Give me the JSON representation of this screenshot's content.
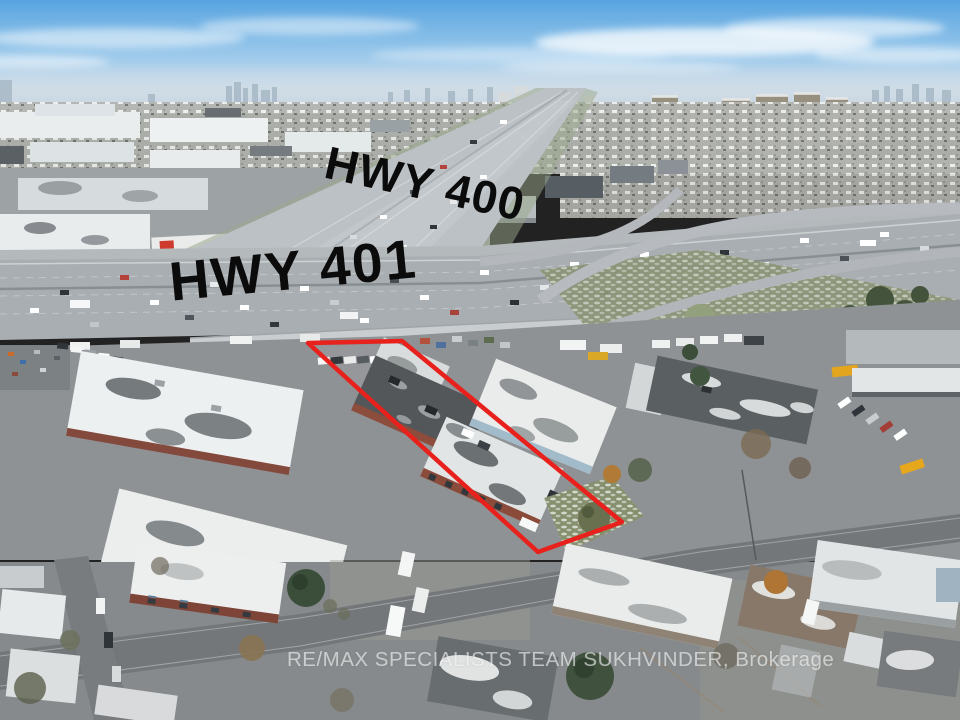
{
  "meta": {
    "type": "aerial-photograph",
    "subject": "Aerial drone view of industrial property near the Hwy 400 / Hwy 401 interchange with light snow dusting",
    "width_px": 960,
    "height_px": 720
  },
  "overlays": {
    "highway_labels": [
      {
        "id": "hwy-400",
        "text": "HWY 400",
        "color": "#0b0b0b"
      },
      {
        "id": "hwy-401",
        "text": "HWY 401",
        "color": "#0b0b0b"
      }
    ],
    "watermark": {
      "text": "RE/MAX SPECIALISTS TEAM SUKHVINDER, Brokerage",
      "color": "#ffffff",
      "opacity": 0.58
    },
    "property_outline": {
      "points": "308,343 402,341 622,522 538,552",
      "color": "#e8211c",
      "stroke_width": "4.5"
    }
  },
  "palette": {
    "sky_top": "#58a4e0",
    "sky_horizon": "#e2ecf4",
    "snow": "#eef0f1",
    "asphalt": "#8f9294",
    "highway": "#a9aeb2",
    "brick": "#8c4c3c",
    "yellow_warehouse": "#eac51f",
    "red_canopy": "#c13a30",
    "blue_facade": "#a2bbca",
    "grass": "#87906e",
    "conifer": "#3b4e3a",
    "autumn_tree": "#b17a36",
    "outline_red": "#e8211c"
  }
}
